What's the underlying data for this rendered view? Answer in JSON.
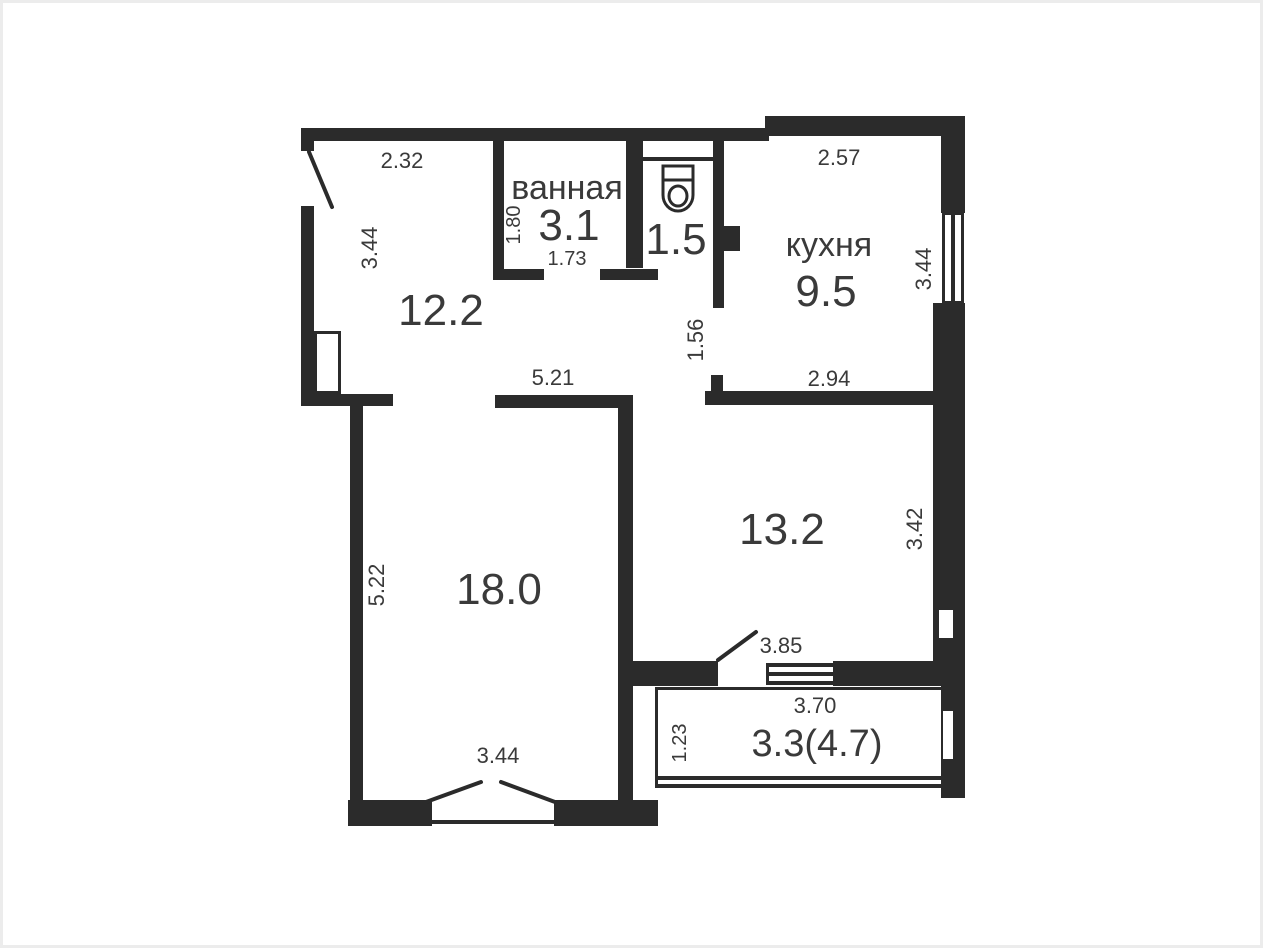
{
  "plan_title": "apartment-floor-plan",
  "colors": {
    "wall": "#2b2b2b",
    "text": "#3a3a3a",
    "background": "#ffffff",
    "frame": "#ececec"
  },
  "icons": {
    "toilet": "toilet-icon"
  },
  "rooms": {
    "hallway": {
      "area": "12.2",
      "dim_top": "2.32",
      "dim_left": "3.44"
    },
    "bathroom": {
      "name": "ванная",
      "area": "3.1",
      "dim_left": "1.80",
      "dim_bottom": "1.73"
    },
    "toilet": {
      "area": "1.5"
    },
    "kitchen": {
      "name": "кухня",
      "area": "9.5",
      "dim_top": "2.57",
      "dim_right": "3.44",
      "dim_left": "1.56",
      "dim_bottom": "2.94"
    },
    "living_room": {
      "area": "18.0",
      "dim_top": "5.21",
      "dim_left": "5.22",
      "dim_bottom": "3.44"
    },
    "room": {
      "area": "13.2",
      "dim_right": "3.42",
      "dim_door": "3.85"
    },
    "balcony": {
      "area": "3.3(4.7)",
      "dim_top": "3.70",
      "dim_left": "1.23"
    }
  }
}
